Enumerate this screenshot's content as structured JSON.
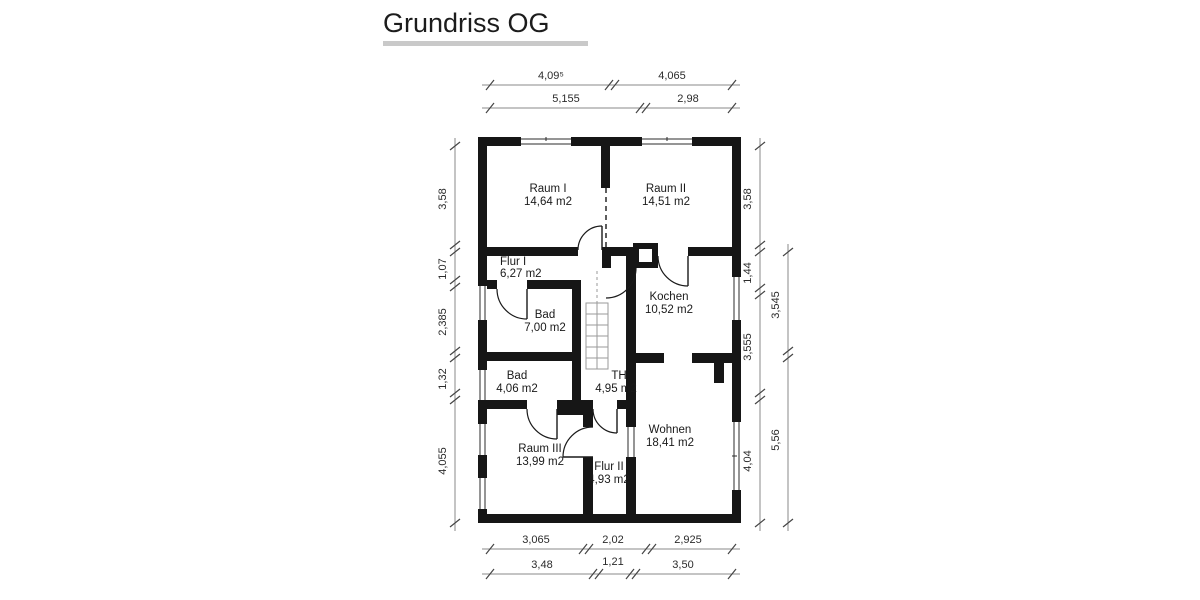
{
  "title": "Grundriss OG",
  "rooms": [
    {
      "name": "Raum I",
      "area": "14,64 m2"
    },
    {
      "name": "Raum II",
      "area": "14,51 m2"
    },
    {
      "name": "Flur I",
      "area": "6,27 m2"
    },
    {
      "name": "Kochen",
      "area": "10,52 m2"
    },
    {
      "name": "Bad",
      "area": "7,00 m2"
    },
    {
      "name": "TH",
      "area": "4,95 m2"
    },
    {
      "name": "Bad",
      "area": "4,06 m2"
    },
    {
      "name": "Raum III",
      "area": "13,99 m2"
    },
    {
      "name": "Flur II",
      "area": "4,93 m2"
    },
    {
      "name": "Wohnen",
      "area": "18,41 m2"
    }
  ],
  "dimensions": {
    "top_row1": [
      "4,09⁵",
      "4,065"
    ],
    "top_row2": [
      "5,155",
      "2,98"
    ],
    "left": [
      "3,58",
      "1,07",
      "2,385",
      "1,32",
      "4,055"
    ],
    "right_inner": [
      "3,58",
      "1,44",
      "3,555",
      "4,04"
    ],
    "right_outer": [
      "3,545",
      "5,56"
    ],
    "bottom_row1": [
      "3,065",
      "2,02",
      "2,925"
    ],
    "bottom_row2": [
      "3,48",
      "1,21",
      "3,50"
    ]
  },
  "colors": {
    "wall": "#161616",
    "underline": "#c9c9c9"
  }
}
